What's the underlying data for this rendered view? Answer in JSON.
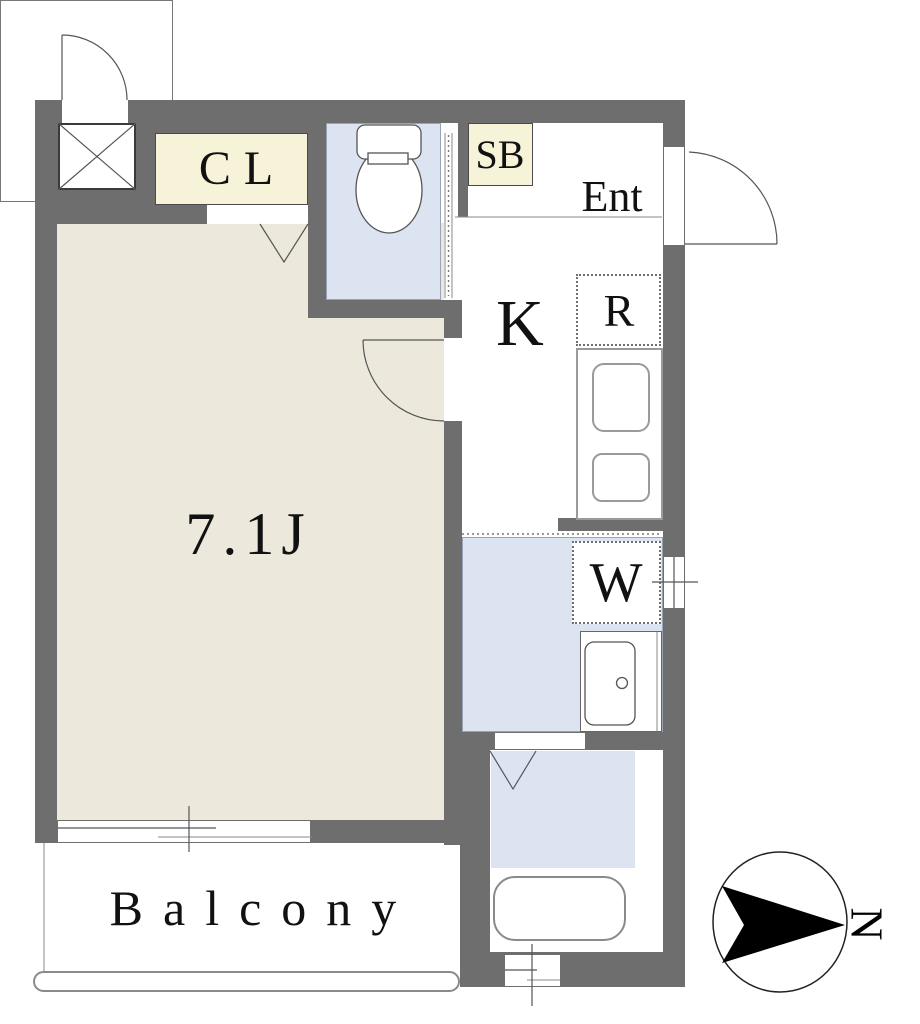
{
  "plan": {
    "rooms": {
      "main_room": {
        "label": "7.1J"
      },
      "kitchen": {
        "label": "K"
      },
      "entrance": {
        "label": "Ent"
      },
      "closet": {
        "label": "CL"
      },
      "shoe_box": {
        "label": "SB"
      },
      "refrigerator_space": {
        "label": "R"
      },
      "washer_space": {
        "label": "W"
      },
      "balcony": {
        "label": "Balcony"
      }
    },
    "compass": {
      "north_label": "N"
    },
    "colors": {
      "wall": "#6e6e6e",
      "floor-main": "#ece8db",
      "floor-wet": "#dce3f1",
      "fill-storage": "#f6f3d9",
      "line": "#555555"
    },
    "icons": [
      "toilet-icon",
      "bathtub-icon",
      "kitchen-sink-icon",
      "stove-icon",
      "washbasin-icon",
      "door-swing-icon",
      "folding-door-icon",
      "sliding-window-icon",
      "shaft-x-icon",
      "compass-icon",
      "north-arrow-icon"
    ]
  }
}
